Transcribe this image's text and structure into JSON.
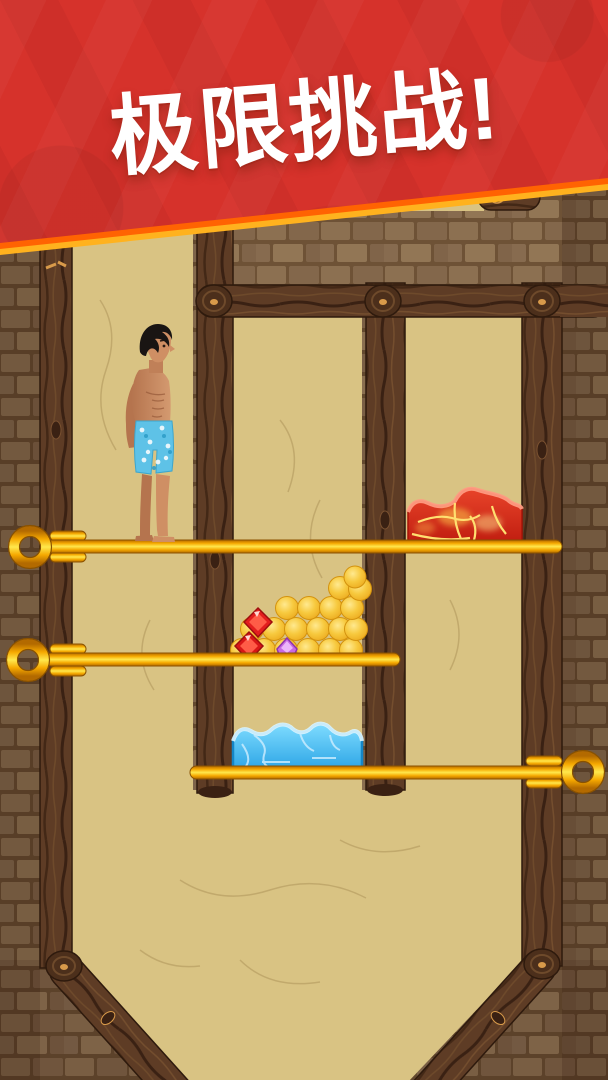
{
  "banner": {
    "title": "极限挑战!",
    "bg_color": "#d6322b",
    "edge_colors": [
      "#ff6302",
      "#ffb21e"
    ],
    "text_color": "#ffffff"
  },
  "scene": {
    "pins": [
      {
        "id": "pin-1",
        "handle_side": "left",
        "label": "gold pin top"
      },
      {
        "id": "pin-2",
        "handle_side": "left",
        "label": "gold pin middle"
      },
      {
        "id": "pin-3",
        "handle_side": "right",
        "label": "gold pin bottom"
      }
    ],
    "objects": [
      {
        "id": "man",
        "label": "shirtless man in blue floral swim trunks"
      },
      {
        "id": "lava",
        "label": "lava blob",
        "color": "#d42a18"
      },
      {
        "id": "honey",
        "label": "honey bubbles",
        "color": "#f6c433"
      },
      {
        "id": "gem-red",
        "label": "red gems",
        "color": "#e32020"
      },
      {
        "id": "gem-purple",
        "label": "purple gem",
        "color": "#c869e3"
      },
      {
        "id": "water",
        "label": "water blob",
        "color": "#45bdf0"
      }
    ],
    "palette": {
      "sand": "#d9c383",
      "wood": "#5e3c25",
      "stone": "#7d6146",
      "pin_gold": "#ffc800"
    }
  }
}
